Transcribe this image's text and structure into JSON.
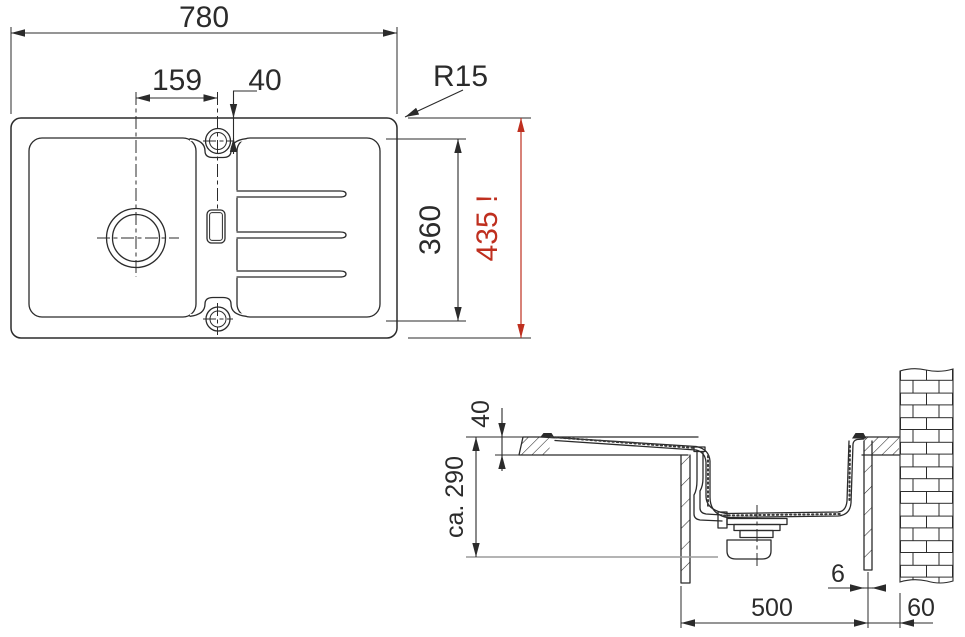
{
  "drawing": {
    "title": "sink-installation-drawing",
    "colors": {
      "line": "#2b2b2b",
      "accent_red": "#bf2f1f",
      "reference_gray": "#9b9b9b"
    },
    "top_view": {
      "overall_width_label": "780",
      "hole_offset_label": "159",
      "rim_width_label": "40",
      "corner_radius_label": "R15",
      "inner_depth_label": "360",
      "overall_depth_label": "435 !"
    },
    "side_view": {
      "counter_thickness_label": "40",
      "install_clearance_label": "ca. 290",
      "panel_thickness_label": "6",
      "cabinet_width_label": "500",
      "wall_offset_label": "60"
    }
  }
}
